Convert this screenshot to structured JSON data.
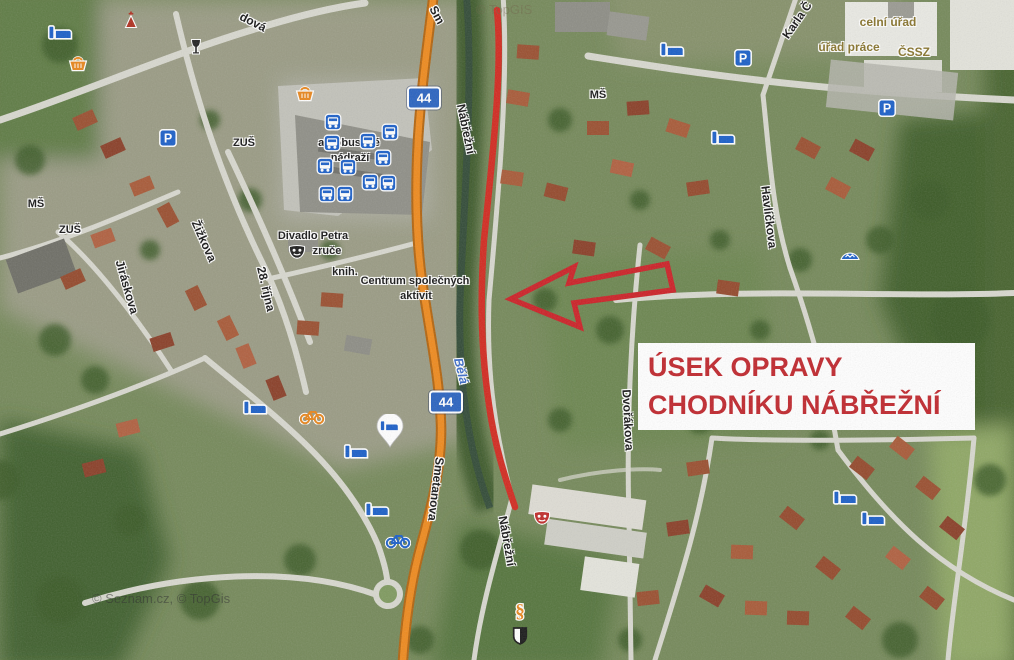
{
  "annotation": {
    "line1": "ÚSEK OPRAVY",
    "line2": "CHODNÍKU NÁBŘEŽNÍ",
    "text_color": "#c0272d",
    "arrow_color": "#cc2127",
    "route_color": "#d22a20"
  },
  "map": {
    "copyright": "© Seznam.cz, © TopGis",
    "watermark": "© TopGIS",
    "colors": {
      "icon_blue": "#1b5fc8",
      "icon_orange": "#e8861c",
      "road_orange": "#ee8a1e"
    },
    "route_shields": [
      {
        "label": "44",
        "x": 424,
        "y": 98
      },
      {
        "label": "44",
        "x": 446,
        "y": 402
      }
    ],
    "street_labels": [
      {
        "text": "dová",
        "x": 253,
        "y": 22,
        "rot": 27
      },
      {
        "text": "Sm",
        "x": 437,
        "y": 15,
        "rot": 62
      },
      {
        "text": "Nábřežní",
        "x": 466,
        "y": 129,
        "rot": 78
      },
      {
        "text": "Karla Č",
        "x": 797,
        "y": 20,
        "rot": -55
      },
      {
        "text": "Havlíčkova",
        "x": 769,
        "y": 217,
        "rot": 83
      },
      {
        "text": "Žižkova",
        "x": 204,
        "y": 241,
        "rot": 66
      },
      {
        "text": "Jiráskova",
        "x": 127,
        "y": 287,
        "rot": 74
      },
      {
        "text": "28. října",
        "x": 266,
        "y": 289,
        "rot": 77
      },
      {
        "text": "Smetanova",
        "x": 436,
        "y": 489,
        "rot": 97
      },
      {
        "text": "Nábřežní",
        "x": 507,
        "y": 541,
        "rot": 80
      },
      {
        "text": "Dvořákova",
        "x": 628,
        "y": 420,
        "rot": 87
      },
      {
        "text": "Bělá",
        "x": 461,
        "y": 371,
        "rot": 76,
        "style": "river"
      }
    ],
    "poi_labels": [
      {
        "text": "MŠ",
        "x": 36,
        "y": 204
      },
      {
        "text": "ZUŠ",
        "x": 70,
        "y": 230
      },
      {
        "text": "ZUŠ",
        "x": 244,
        "y": 143
      },
      {
        "text": "MŠ",
        "x": 598,
        "y": 95
      },
      {
        "text": "Divadlo Petra",
        "x": 313,
        "y": 236
      },
      {
        "text": "zruče",
        "x": 327,
        "y": 251
      },
      {
        "text": "knih.",
        "x": 345,
        "y": 272
      },
      {
        "text": "Centrum společných",
        "x": 415,
        "y": 281
      },
      {
        "text": "aktivit",
        "x": 416,
        "y": 296
      },
      {
        "text": "autobusové",
        "x": 349,
        "y": 143
      },
      {
        "text": "nádraží",
        "x": 350,
        "y": 158
      },
      {
        "text": "celní úřad",
        "x": 888,
        "y": 22,
        "style": "office"
      },
      {
        "text": "úřad práce",
        "x": 849,
        "y": 47,
        "style": "office"
      },
      {
        "text": "ČSSZ",
        "x": 914,
        "y": 52,
        "style": "office"
      }
    ],
    "icons": [
      {
        "type": "bed",
        "x": 60,
        "y": 33
      },
      {
        "type": "bed",
        "x": 672,
        "y": 50
      },
      {
        "type": "bed",
        "x": 723,
        "y": 138
      },
      {
        "type": "bed",
        "x": 255,
        "y": 408
      },
      {
        "type": "bed",
        "x": 356,
        "y": 452
      },
      {
        "type": "bed",
        "x": 377,
        "y": 510
      },
      {
        "type": "bed",
        "x": 845,
        "y": 498
      },
      {
        "type": "bed",
        "x": 873,
        "y": 519
      },
      {
        "type": "bed-pin",
        "x": 390,
        "y": 431
      },
      {
        "type": "parking",
        "x": 168,
        "y": 138
      },
      {
        "type": "parking",
        "x": 743,
        "y": 58
      },
      {
        "type": "parking",
        "x": 887,
        "y": 108
      },
      {
        "type": "basket",
        "x": 78,
        "y": 63
      },
      {
        "type": "basket",
        "x": 305,
        "y": 93
      },
      {
        "type": "bus",
        "x": 333,
        "y": 122
      },
      {
        "type": "bus",
        "x": 390,
        "y": 132
      },
      {
        "type": "bus",
        "x": 368,
        "y": 141
      },
      {
        "type": "bus",
        "x": 332,
        "y": 143
      },
      {
        "type": "bus",
        "x": 383,
        "y": 158
      },
      {
        "type": "bus",
        "x": 325,
        "y": 166
      },
      {
        "type": "bus",
        "x": 348,
        "y": 167
      },
      {
        "type": "bus",
        "x": 370,
        "y": 182
      },
      {
        "type": "bus",
        "x": 388,
        "y": 183
      },
      {
        "type": "bus",
        "x": 327,
        "y": 194
      },
      {
        "type": "bus",
        "x": 345,
        "y": 194
      },
      {
        "type": "bike-orange",
        "x": 312,
        "y": 416
      },
      {
        "type": "bike-blue",
        "x": 398,
        "y": 540
      },
      {
        "type": "mask-black",
        "x": 297,
        "y": 252
      },
      {
        "type": "mask-red",
        "x": 542,
        "y": 518
      },
      {
        "type": "paragraph",
        "x": 520,
        "y": 611
      },
      {
        "type": "shield-bw",
        "x": 520,
        "y": 636
      },
      {
        "type": "chapel",
        "x": 131,
        "y": 20
      },
      {
        "type": "pub",
        "x": 196,
        "y": 47
      },
      {
        "type": "viewpoint",
        "x": 850,
        "y": 254
      }
    ]
  }
}
